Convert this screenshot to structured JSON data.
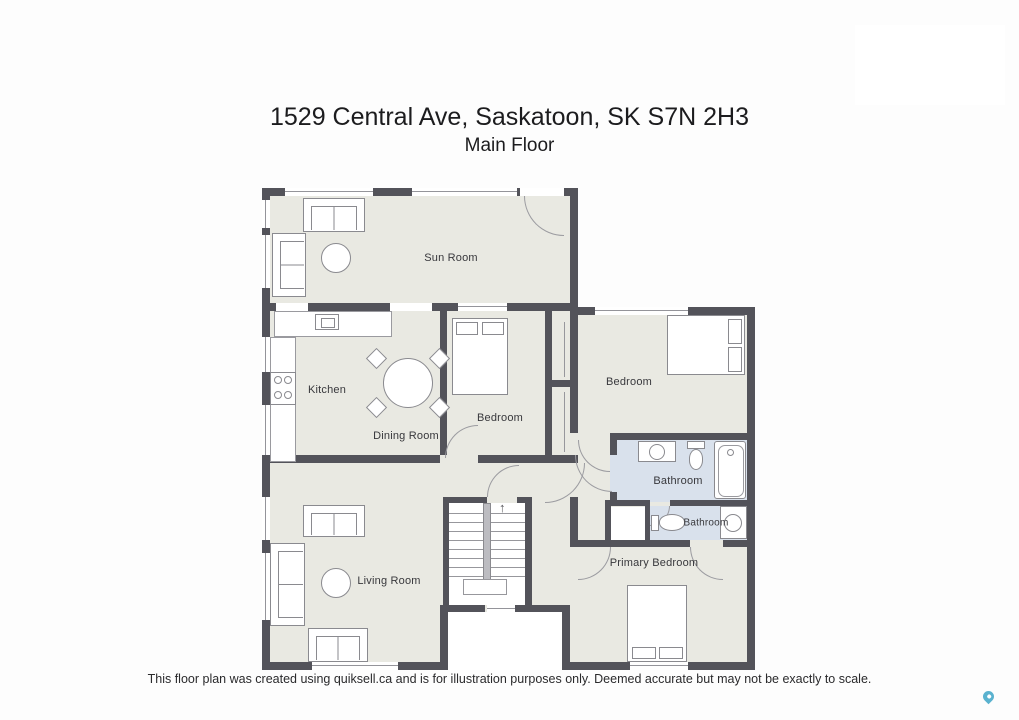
{
  "header": {
    "title": "1529 Central Ave, Saskatoon, SK S7N 2H3",
    "subtitle": "Main Floor"
  },
  "footer": {
    "disclaimer": "This floor plan was created using quiksell.ca and is for illustration purposes only. Deemed accurate but may not be exactly to scale."
  },
  "rooms": {
    "sun_room": {
      "label": "Sun Room"
    },
    "kitchen": {
      "label": "Kitchen"
    },
    "dining_room": {
      "label": "Dining Room"
    },
    "bedroom_middle": {
      "label": "Bedroom"
    },
    "bedroom_right": {
      "label": "Bedroom"
    },
    "bathroom_main": {
      "label": "Bathroom"
    },
    "bathroom_half": {
      "label": "Bathroom"
    },
    "living_room": {
      "label": "Living Room"
    },
    "primary_bedroom": {
      "label": "Primary Bedroom"
    }
  },
  "icons": {
    "stairs_up_arrow": "↑",
    "map_pin": "map-pin-icon"
  },
  "colors": {
    "wall": "#53535a",
    "floor": "#e9e9e2",
    "bathroom_floor": "#d9e1ec",
    "furniture_line": "#8a8a8f",
    "pin": "#5ab2cf"
  }
}
